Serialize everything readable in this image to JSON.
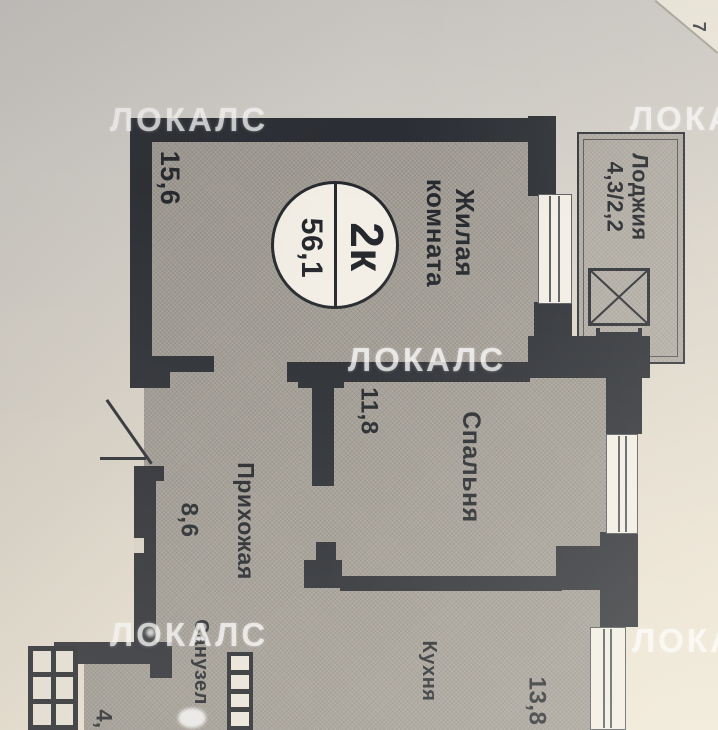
{
  "watermark": {
    "text": "ЛОКАЛС"
  },
  "page": {
    "corner_number": "7"
  },
  "badge": {
    "type": "2к",
    "total_area": "56,1"
  },
  "rooms": {
    "living": {
      "name_line1": "Жилая",
      "name_line2": "комната",
      "area": "15,6"
    },
    "loggia": {
      "name": "Лоджия",
      "area": "4,3/2,2"
    },
    "bedroom": {
      "name": "Спальня",
      "area": "11,8"
    },
    "hallway": {
      "name": "Прихожая",
      "area": "8,6"
    },
    "kitchen": {
      "name": "Кухня",
      "area": "13,8"
    },
    "bathroom": {
      "name": "Санузел",
      "area": "4,"
    }
  },
  "colors": {
    "wall": "#2a2d33",
    "paper_dark": "#cdcac6",
    "paper_light": "#efe7d6",
    "room_fill": "#a7a29a",
    "loggia_fill": "#b4afa7",
    "watermark": "#fcfcfc"
  }
}
